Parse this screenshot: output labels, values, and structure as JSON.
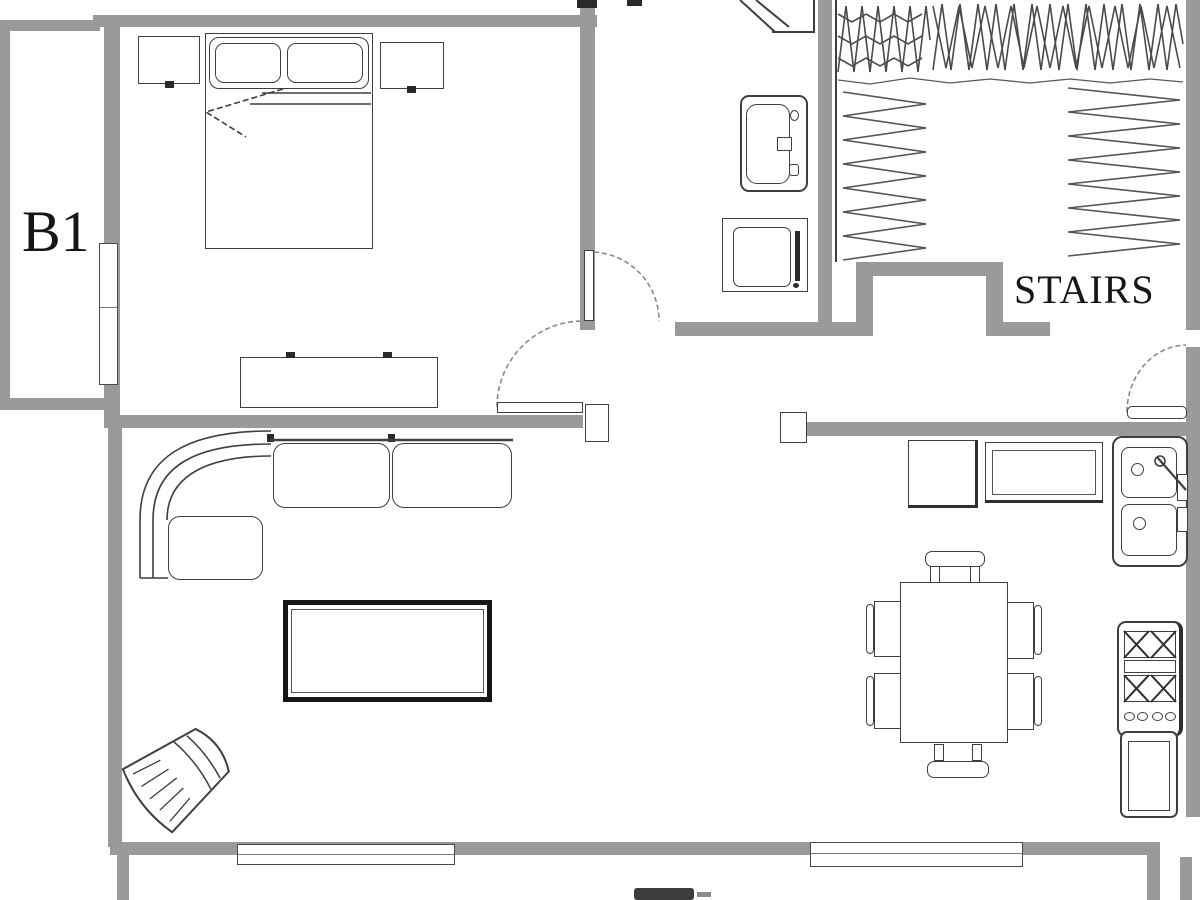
{
  "plan": {
    "labels": {
      "unit": "B1",
      "stairs": "STAIRS"
    },
    "colors": {
      "wall": "#9a9a9a",
      "line": "#3f3f3f",
      "bold_furniture": "#161616",
      "arc": "#8a8a8a",
      "text": "#161616",
      "background": "#ffffff"
    },
    "rooms": [
      {
        "id": "bedroom-b1",
        "label": "B1"
      },
      {
        "id": "bathroom",
        "label": ""
      },
      {
        "id": "stairs",
        "label": "STAIRS"
      },
      {
        "id": "living-room",
        "label": ""
      },
      {
        "id": "dining-area",
        "label": ""
      },
      {
        "id": "kitchen",
        "label": ""
      }
    ],
    "furniture": [
      "double-bed",
      "pillow",
      "nightstand-left",
      "nightstand-right",
      "dresser",
      "corner-shower",
      "bathroom-sink",
      "toilet",
      "sectional-sofa",
      "coffee-table",
      "corner-armchair",
      "dining-table",
      "dining-chair",
      "refrigerator",
      "kitchen-counter",
      "kitchen-sink",
      "stove",
      "base-cabinet",
      "window",
      "door"
    ]
  }
}
